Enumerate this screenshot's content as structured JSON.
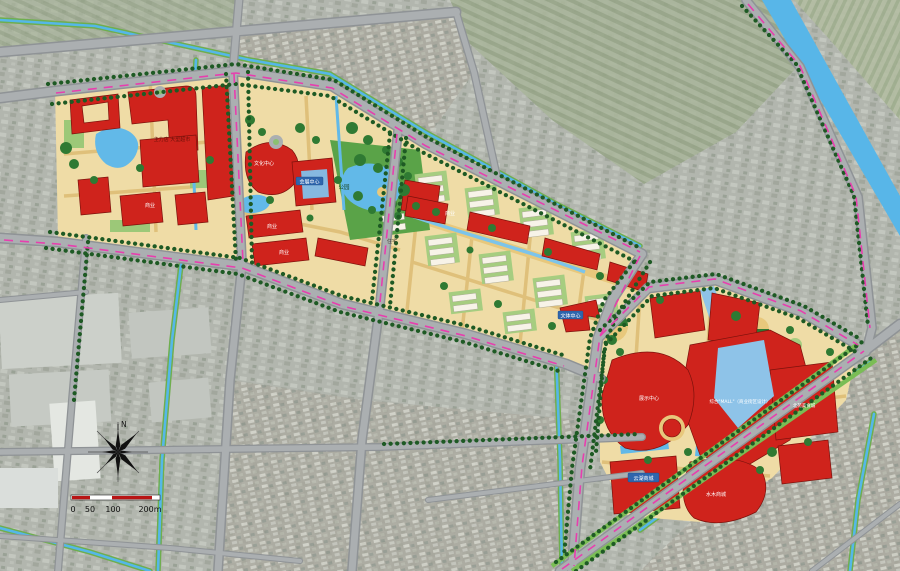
{
  "compass": {
    "north": "N"
  },
  "scale_bar": {
    "tick_0": "0",
    "tick_50": "50",
    "tick_100": "100",
    "tick_200": "200m"
  },
  "labels": {
    "west": {
      "anchor_store": "主力店 大型超市",
      "commerce": "商业"
    },
    "culture": {
      "culture_center": "文化中心",
      "exhibition_center": "会展中心",
      "park": "公园",
      "commerce_a": "商业",
      "commerce_b": "商业",
      "residence": "住宅"
    },
    "residential": {
      "commerce_strip": "商业",
      "sports_center": "文体中心"
    },
    "east": {
      "display_center": "展示中心",
      "mall": "综合\"MALL\"（商业街区设计）",
      "food_city": "北苑美食城",
      "yunhu_mall": "云湖商城",
      "shuimu_mall": "水木商城"
    }
  },
  "colors": {
    "building_red": "#cf231c",
    "plan_cream": "#efdca6",
    "water_blue": "#62b9e8",
    "road_gray": "#abafb1",
    "pink_dash": "#e73fae",
    "tree_green": "#1e5a24"
  }
}
